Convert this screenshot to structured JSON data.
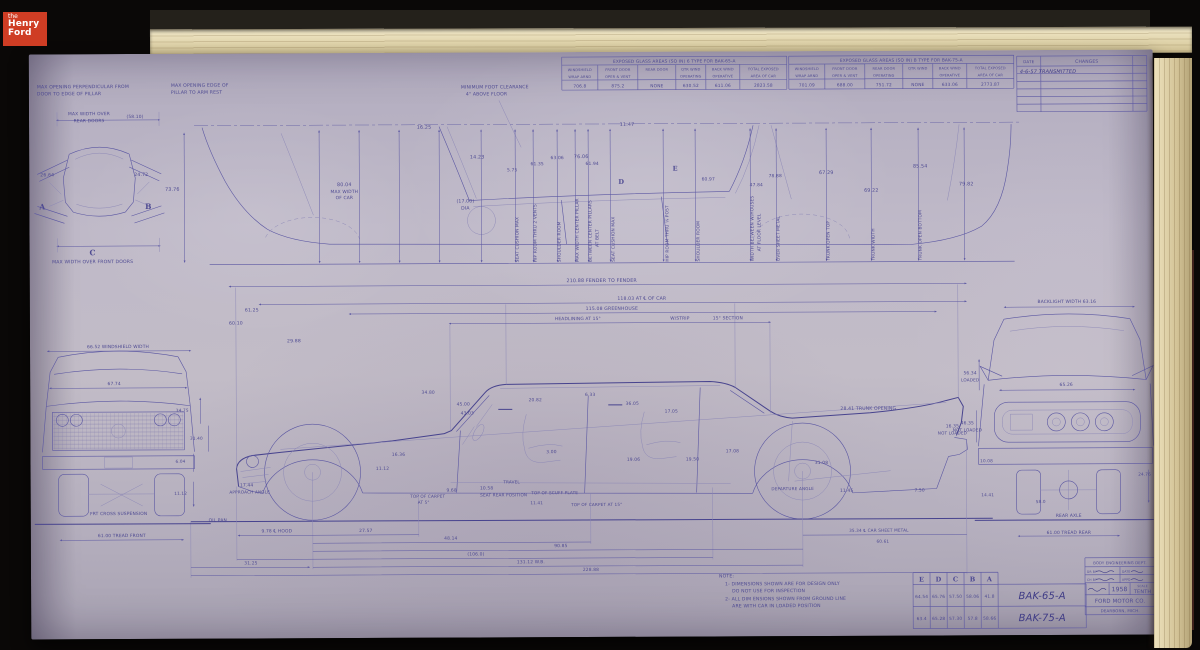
{
  "meta": {
    "logo": {
      "line1": "the",
      "line2": "Henry",
      "line3": "Ford"
    }
  },
  "colors": {
    "paper": "#bcb6c4",
    "ink": "#55519b",
    "ink_strong": "#454189",
    "logo_red": "#cf3d24",
    "pages_cream": "#e7ddbe",
    "background": "#0a0807"
  },
  "tables": {
    "glass_a": {
      "title": "EXPOSED GLASS AREAS (SQ IN) 6 TYPE FOR BAK-65-A",
      "headers": [
        "WINDSHIELD",
        "FRONT DOOR",
        "REAR DOOR",
        "QTR WIND",
        "BACK WIND",
        "TOTAL EXPOSED"
      ],
      "subheaders": [
        "WRAP ARND",
        "OPER & VENT",
        "",
        "OPERATING",
        "OPERATIVE",
        "AREA OF CAR"
      ],
      "values": [
        "706.8",
        "875.2",
        "NONE",
        "630.52",
        "611.06",
        "2823.58"
      ]
    },
    "glass_b": {
      "title": "EXPOSED GLASS AREAS (SQ IN) B TYPE FOR BAK-75-A",
      "headers": [
        "WINDSHIELD",
        "FRONT DOOR",
        "REAR DOOR",
        "QTR WIND",
        "BACK WIND",
        "TOTAL EXPOSED"
      ],
      "subheaders": [
        "WRAP ARND",
        "OPER & VENT",
        "OPERATING",
        "",
        "OPERATIVE",
        "AREA OF CAR"
      ],
      "values": [
        "701.09",
        "688.00",
        "751.72",
        "NONE",
        "633.06",
        "2773.87"
      ]
    },
    "changes": {
      "date_header": "DATE",
      "changes_header": "CHANGES",
      "entries": [
        "4-6-57  TRANSMITTED"
      ],
      "empty_rows": 5
    },
    "sections": {
      "columns": [
        "E",
        "D",
        "C",
        "B",
        "A"
      ],
      "rows": [
        {
          "values": [
            "64.54",
            "65.76",
            "57.50",
            "58.06",
            "41.8"
          ],
          "drawing": "BAK-65-A"
        },
        {
          "values": [
            "63.4",
            "65.28",
            "57.30",
            "57.8",
            "58.66"
          ],
          "drawing": "BAK-75-A"
        }
      ]
    }
  },
  "title_block": {
    "department": "BODY ENGINEERING DEPT.",
    "drawn_label": "DR BY",
    "date_label": "DATE",
    "checked_label": "CH BY",
    "approved_label": "APPD",
    "year": "1958",
    "scale_label": "SCALE",
    "scale": "TENTH",
    "company": "FORD MOTOR CO.",
    "location": "DEARBORN, MICH."
  },
  "notes": {
    "heading": "NOTE:",
    "lines": [
      "1- DIMENSIONS SHOWN ARE FOR DESIGN ONLY",
      "DO NOT USE FOR INSPECTION",
      "2- ALL DIM ENSIONS SHOWN FROM GROUND LINE",
      "ARE WITH CAR IN LOADED POSITION"
    ]
  },
  "annotations": [
    {
      "t": "MAX OPENING PERPENDICULAR FROM",
      "x": 8,
      "y": 34,
      "s": 4.6,
      "a": "start"
    },
    {
      "t": "DOOR TO EDGE OF PILLAR",
      "x": 8,
      "y": 41,
      "s": 4.6,
      "a": "start"
    },
    {
      "t": "MAX WIDTH OVER",
      "x": 60,
      "y": 61,
      "s": 4.4
    },
    {
      "t": "REAR DOORS",
      "x": 60,
      "y": 68,
      "s": 4.4
    },
    {
      "t": "(58.10)",
      "x": 106,
      "y": 64,
      "s": 4.4
    },
    {
      "t": "26.64",
      "x": 18,
      "y": 122,
      "s": 4.6
    },
    {
      "t": "24.72",
      "x": 112,
      "y": 122,
      "s": 4.6
    },
    {
      "t": "A",
      "x": 13,
      "y": 155,
      "s": 7.5,
      "c": "sec"
    },
    {
      "t": "B",
      "x": 119,
      "y": 155,
      "s": 7.5,
      "c": "sec"
    },
    {
      "t": "C",
      "x": 63,
      "y": 201,
      "s": 7.5,
      "c": "sec"
    },
    {
      "t": "MAX WIDTH OVER FRONT DOORS",
      "x": 63,
      "y": 209,
      "s": 4.6
    },
    {
      "t": "MAX OPENING EDGE OF",
      "x": 142,
      "y": 33,
      "s": 4.6,
      "a": "start"
    },
    {
      "t": "PILLAR TO ARM REST",
      "x": 142,
      "y": 40,
      "s": 4.6,
      "a": "start"
    },
    {
      "t": "73.76",
      "x": 143,
      "y": 137,
      "s": 4.8
    },
    {
      "t": "MINIMUM FOOT CLEARANCE",
      "x": 432,
      "y": 36,
      "s": 4.6,
      "a": "start"
    },
    {
      "t": "4\" ABOVE FLOOR",
      "x": 437,
      "y": 43,
      "s": 4.6,
      "a": "start"
    },
    {
      "t": "14.23",
      "x": 448,
      "y": 106,
      "s": 4.8
    },
    {
      "t": "16.25",
      "x": 395,
      "y": 76,
      "s": 4.8
    },
    {
      "t": "11.47",
      "x": 598,
      "y": 74,
      "s": 4.8
    },
    {
      "t": "76.06",
      "x": 552,
      "y": 106,
      "s": 4.8
    },
    {
      "t": "80.04",
      "x": 315,
      "y": 133,
      "s": 4.8
    },
    {
      "t": "MAX WIDTH",
      "x": 315,
      "y": 140,
      "s": 4.4
    },
    {
      "t": "OF CAR",
      "x": 315,
      "y": 146,
      "s": 4.4
    },
    {
      "t": "(17.00)",
      "x": 436,
      "y": 150,
      "s": 4.6
    },
    {
      "t": "DIA",
      "x": 436,
      "y": 157,
      "s": 4.6
    },
    {
      "t": "5.75",
      "x": 483,
      "y": 119,
      "s": 4.4
    },
    {
      "t": "61.35",
      "x": 508,
      "y": 113,
      "s": 4.4
    },
    {
      "t": "63.06",
      "x": 528,
      "y": 107,
      "s": 4.4
    },
    {
      "t": "61.94",
      "x": 563,
      "y": 113,
      "s": 4.4
    },
    {
      "t": "60.97",
      "x": 679,
      "y": 129,
      "s": 4.4
    },
    {
      "t": "D",
      "x": 592,
      "y": 132,
      "s": 6.5,
      "c": "sec"
    },
    {
      "t": "E",
      "x": 646,
      "y": 119,
      "s": 6.5,
      "c": "sec"
    },
    {
      "t": "47.84",
      "x": 727,
      "y": 135,
      "s": 4.4
    },
    {
      "t": "78.88",
      "x": 746,
      "y": 126,
      "s": 4.4
    },
    {
      "t": "67.29",
      "x": 797,
      "y": 123,
      "s": 4.8
    },
    {
      "t": "69.22",
      "x": 842,
      "y": 141,
      "s": 4.8
    },
    {
      "t": "85.54",
      "x": 891,
      "y": 117,
      "s": 4.8
    },
    {
      "t": "79.82",
      "x": 937,
      "y": 135,
      "s": 4.8
    },
    {
      "t": "SEAT CUSHION MAX",
      "x": 489,
      "y": 210,
      "s": 4.3,
      "r": -90,
      "a": "start"
    },
    {
      "t": "HIP ROOM THRU 2 VENTS",
      "x": 507,
      "y": 210,
      "s": 4.3,
      "r": -90,
      "a": "start"
    },
    {
      "t": "SHOULDER ROOM",
      "x": 531,
      "y": 210,
      "s": 4.3,
      "r": -90,
      "a": "start"
    },
    {
      "t": "MAX WIDTH CENTER PILLAR",
      "x": 549,
      "y": 210,
      "s": 4.3,
      "r": -90,
      "a": "start"
    },
    {
      "t": "BETWEEN CENTER PILLARS",
      "x": 562,
      "y": 210,
      "s": 4.3,
      "r": -90,
      "a": "start"
    },
    {
      "t": "AT BELT",
      "x": 569,
      "y": 195,
      "s": 4.3,
      "r": -90,
      "a": "start"
    },
    {
      "t": "SEAT CUSHION MAX",
      "x": 585,
      "y": 210,
      "s": 4.3,
      "r": -90,
      "a": "start"
    },
    {
      "t": "HIP ROOM THRU ¼ POST",
      "x": 639,
      "y": 210,
      "s": 4.3,
      "r": -90,
      "a": "start"
    },
    {
      "t": "SHOULDER ROOM",
      "x": 670,
      "y": 210,
      "s": 4.3,
      "r": -90,
      "a": "start"
    },
    {
      "t": "WIDTH BETWEEN W/HOUSES",
      "x": 724,
      "y": 210,
      "s": 4.3,
      "r": -90,
      "a": "start"
    },
    {
      "t": "AT FLOOR LEVEL",
      "x": 731,
      "y": 200,
      "s": 4.3,
      "r": -90,
      "a": "start"
    },
    {
      "t": "OVER SHEET METAL",
      "x": 750,
      "y": 210,
      "s": 4.3,
      "r": -90,
      "a": "start"
    },
    {
      "t": "TRUNK OPEN TOP",
      "x": 800,
      "y": 210,
      "s": 4.3,
      "r": -90,
      "a": "start"
    },
    {
      "t": "TRUNK WIDTH",
      "x": 845,
      "y": 210,
      "s": 4.3,
      "r": -90,
      "a": "start"
    },
    {
      "t": "TRUNK OPEN BOTTOM",
      "x": 892,
      "y": 210,
      "s": 4.3,
      "r": -90,
      "a": "start"
    },
    {
      "t": "210.88  FENDER TO FENDER",
      "x": 572,
      "y": 230,
      "s": 4.8
    },
    {
      "t": "118.03  AT ℄ OF CAR",
      "x": 612,
      "y": 248,
      "s": 4.6
    },
    {
      "t": "115.08  GREENHOUSE",
      "x": 582,
      "y": 258,
      "s": 4.6
    },
    {
      "t": "HEADLINING AT 15°",
      "x": 548,
      "y": 268,
      "s": 4.4
    },
    {
      "t": "W/STRIP",
      "x": 650,
      "y": 268,
      "s": 4.4
    },
    {
      "t": "15° SECTION",
      "x": 698,
      "y": 268,
      "s": 4.4
    },
    {
      "t": "61.25",
      "x": 222,
      "y": 258,
      "s": 4.6
    },
    {
      "t": "60.10",
      "x": 206,
      "y": 271,
      "s": 4.6
    },
    {
      "t": "29.88",
      "x": 264,
      "y": 289,
      "s": 4.6
    },
    {
      "t": "34.80",
      "x": 398,
      "y": 341,
      "s": 4.4
    },
    {
      "t": "45.00",
      "x": 433,
      "y": 353,
      "s": 4.4
    },
    {
      "t": "43.03",
      "x": 437,
      "y": 362,
      "s": 4.4
    },
    {
      "t": "20.82",
      "x": 505,
      "y": 349,
      "s": 4.4
    },
    {
      "t": "6.33",
      "x": 560,
      "y": 344,
      "s": 4.4
    },
    {
      "t": "36.05",
      "x": 602,
      "y": 353,
      "s": 4.4
    },
    {
      "t": "17.05",
      "x": 641,
      "y": 361,
      "s": 4.4
    },
    {
      "t": "16.36",
      "x": 368,
      "y": 403,
      "s": 4.4
    },
    {
      "t": "11.12",
      "x": 352,
      "y": 417,
      "s": 4.4
    },
    {
      "t": "9.68",
      "x": 421,
      "y": 439,
      "s": 4.4
    },
    {
      "t": "10.58",
      "x": 456,
      "y": 437,
      "s": 4.4
    },
    {
      "t": "TRAVEL",
      "x": 481,
      "y": 431,
      "s": 4.2
    },
    {
      "t": "3.00",
      "x": 521,
      "y": 401,
      "s": 4.4
    },
    {
      "t": "19.06",
      "x": 603,
      "y": 409,
      "s": 4.4
    },
    {
      "t": "19.50",
      "x": 662,
      "y": 409,
      "s": 4.4
    },
    {
      "t": "17.08",
      "x": 702,
      "y": 401,
      "s": 4.4
    },
    {
      "t": "31.08",
      "x": 791,
      "y": 413,
      "s": 4.4
    },
    {
      "t": "28.41  TRUNK OPENING",
      "x": 838,
      "y": 359,
      "s": 4.6
    },
    {
      "t": "16.35",
      "x": 922,
      "y": 377,
      "s": 4.4
    },
    {
      "t": "NOT LOADED",
      "x": 922,
      "y": 384,
      "s": 4.2
    },
    {
      "t": "17.44",
      "x": 216,
      "y": 433,
      "s": 4.4
    },
    {
      "t": "APPROACH ANGLE",
      "x": 219,
      "y": 440,
      "s": 4.2
    },
    {
      "t": "DEPARTURE ANGLE",
      "x": 762,
      "y": 439,
      "s": 4.2
    },
    {
      "t": "11.45",
      "x": 816,
      "y": 441,
      "s": 4.4
    },
    {
      "t": "7.50",
      "x": 889,
      "y": 441,
      "s": 4.4
    },
    {
      "t": "OIL PAN",
      "x": 187,
      "y": 468,
      "s": 4.4
    },
    {
      "t": "TOP OF CARPET",
      "x": 397,
      "y": 445,
      "s": 4.2
    },
    {
      "t": "AT 5°",
      "x": 393,
      "y": 451,
      "s": 4.2
    },
    {
      "t": "SEAT REAR POSITION",
      "x": 473,
      "y": 444,
      "s": 4.2
    },
    {
      "t": "TOP OF SCUFF PLATE",
      "x": 524,
      "y": 442,
      "s": 4.2
    },
    {
      "t": "11.41",
      "x": 506,
      "y": 452,
      "s": 4.2
    },
    {
      "t": "TOP OF CARPET AT 15°",
      "x": 566,
      "y": 454,
      "s": 4.2
    },
    {
      "t": "9.78 ℄ HOOD",
      "x": 246,
      "y": 479,
      "s": 4.4
    },
    {
      "t": "27.57",
      "x": 335,
      "y": 479,
      "s": 4.4
    },
    {
      "t": "48.14",
      "x": 420,
      "y": 487,
      "s": 4.4
    },
    {
      "t": "90.85",
      "x": 530,
      "y": 495,
      "s": 4.4
    },
    {
      "t": "(106.0)",
      "x": 445,
      "y": 503,
      "s": 4.4
    },
    {
      "t": "131.12  W.B.",
      "x": 500,
      "y": 511,
      "s": 4.4
    },
    {
      "t": "228.88",
      "x": 560,
      "y": 519,
      "s": 4.4
    },
    {
      "t": "35.34 ℄ CAR SHEET METAL",
      "x": 848,
      "y": 481,
      "s": 4.2
    },
    {
      "t": "60.61",
      "x": 852,
      "y": 492,
      "s": 4.2
    },
    {
      "t": "31.25",
      "x": 220,
      "y": 511,
      "s": 4.4
    },
    {
      "t": "66.52 WINDSHIELD WIDTH",
      "x": 88,
      "y": 294,
      "s": 4.4
    },
    {
      "t": "67.74",
      "x": 84,
      "y": 331,
      "s": 4.4
    },
    {
      "t": "FRT CROSS SUSPENSION",
      "x": 88,
      "y": 461,
      "s": 4.4
    },
    {
      "t": "61.00 TREAD FRONT",
      "x": 91,
      "y": 483,
      "s": 4.4
    },
    {
      "t": "34.75",
      "x": 152,
      "y": 358,
      "s": 4.2
    },
    {
      "t": "31.40",
      "x": 166,
      "y": 386,
      "s": 4.2
    },
    {
      "t": "6.04",
      "x": 150,
      "y": 409,
      "s": 4.2
    },
    {
      "t": "11.12",
      "x": 150,
      "y": 441,
      "s": 4.2
    },
    {
      "t": "BACKLIGHT WIDTH 63.16",
      "x": 1037,
      "y": 253,
      "s": 4.4
    },
    {
      "t": "56.34",
      "x": 940,
      "y": 324,
      "s": 4.4
    },
    {
      "t": "LOADED",
      "x": 940,
      "y": 331,
      "s": 4.2
    },
    {
      "t": "46.35",
      "x": 937,
      "y": 374,
      "s": 4.4
    },
    {
      "t": "NOT LOADED",
      "x": 937,
      "y": 381,
      "s": 4.2
    },
    {
      "t": "65.26",
      "x": 1036,
      "y": 336,
      "s": 4.4
    },
    {
      "t": "REAR AXLE",
      "x": 1038,
      "y": 467,
      "s": 4.4
    },
    {
      "t": "61.00 TREAD REAR",
      "x": 1038,
      "y": 484,
      "s": 4.4
    },
    {
      "t": "10.08",
      "x": 956,
      "y": 412,
      "s": 4.2
    },
    {
      "t": "14.41",
      "x": 957,
      "y": 446,
      "s": 4.2
    },
    {
      "t": "58.0",
      "x": 1010,
      "y": 453,
      "s": 4.2
    },
    {
      "t": "24.76",
      "x": 1114,
      "y": 426,
      "s": 4.2
    }
  ]
}
